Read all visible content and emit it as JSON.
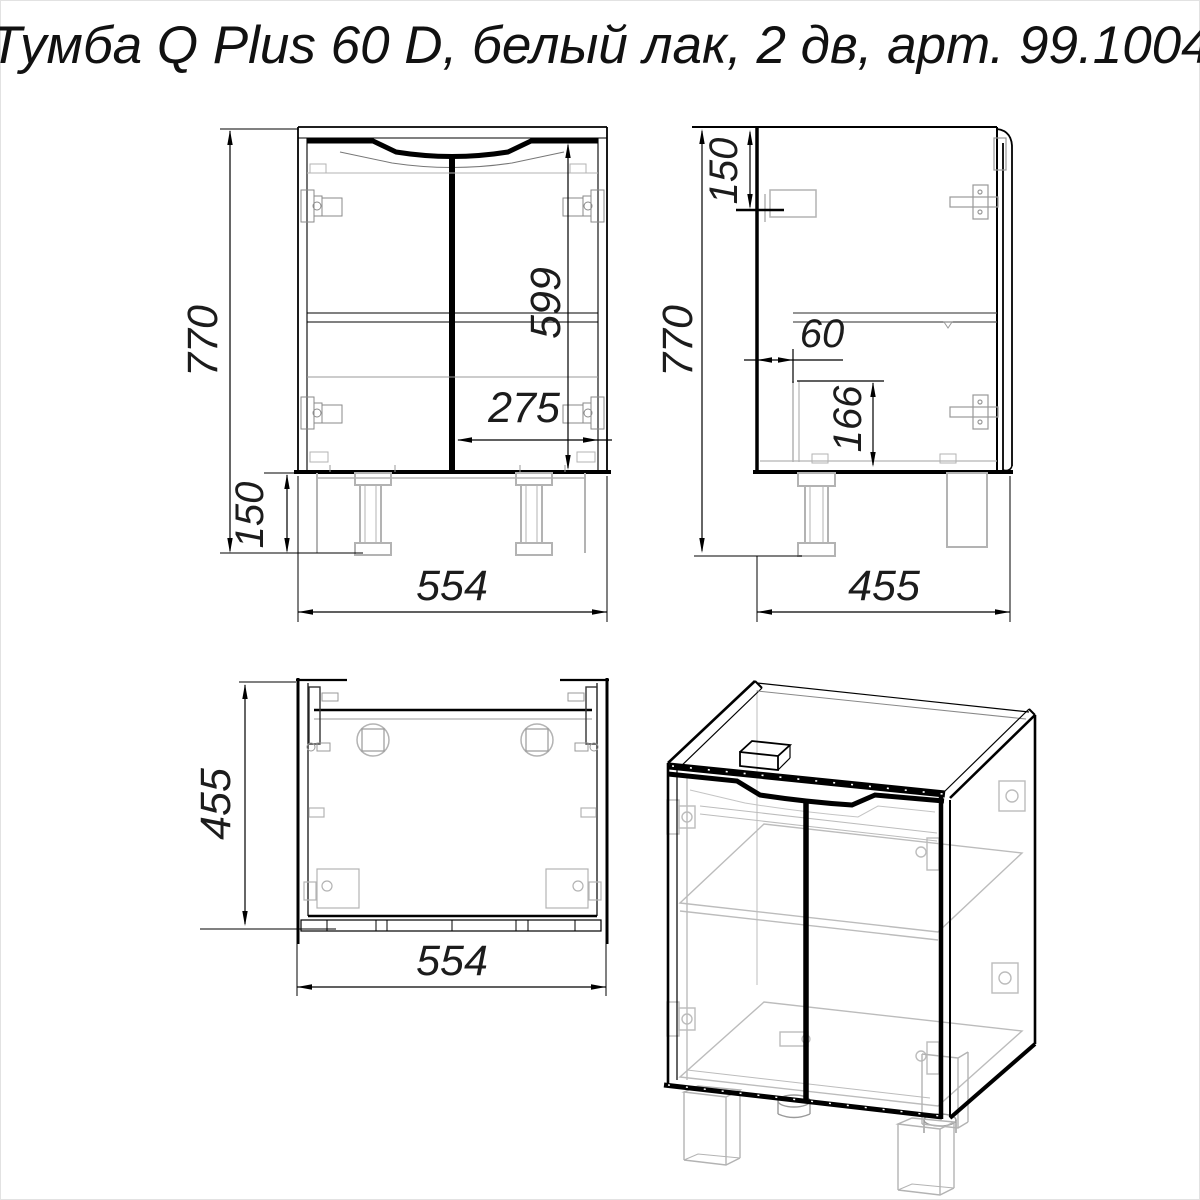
{
  "title": "Тумба Q Plus 60 D, белый лак, 2 дв, арт. 99.1004",
  "views": {
    "front": {
      "dims": {
        "overall_height": "770",
        "leg_height": "150",
        "door_height": "599",
        "door_width": "275",
        "overall_width": "554"
      }
    },
    "side": {
      "dims": {
        "bracket_offset": "150",
        "overall_height": "770",
        "siphon_offset": "60",
        "siphon_height": "166",
        "overall_depth": "455"
      }
    },
    "top": {
      "dims": {
        "depth": "455",
        "width": "554"
      }
    }
  },
  "colors": {
    "line": "#000000",
    "auxiliary": "#b3b3b3",
    "background": "#ffffff"
  }
}
